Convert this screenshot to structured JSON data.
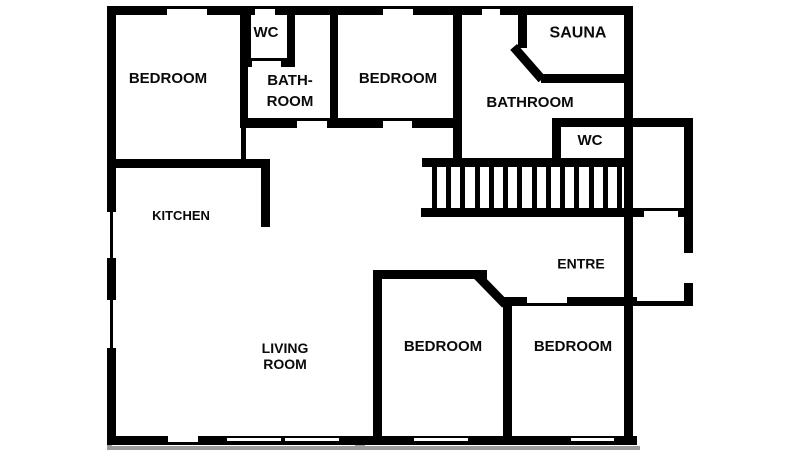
{
  "figure": {
    "width": 800,
    "height": 450,
    "background": "#ffffff"
  },
  "palette": {
    "wall": "#000000",
    "line": "#000000",
    "cut": "#ffffff",
    "shadow": "#9b9b9b"
  },
  "rooms": [
    {
      "id": "bedroom-top-left",
      "lines": [
        "BEDROOM"
      ],
      "cx": 168,
      "cy": 79,
      "fs": 15,
      "lh": 18
    },
    {
      "id": "wc-top",
      "lines": [
        "WC"
      ],
      "cx": 266,
      "cy": 33,
      "fs": 15,
      "lh": 18
    },
    {
      "id": "bathroom-small",
      "lines": [
        "BATH-",
        "ROOM"
      ],
      "cx": 290,
      "cy": 91,
      "fs": 15,
      "lh": 21
    },
    {
      "id": "bedroom-top-middle",
      "lines": [
        "BEDROOM"
      ],
      "cx": 398,
      "cy": 79,
      "fs": 15,
      "lh": 18
    },
    {
      "id": "sauna",
      "lines": [
        "SAUNA"
      ],
      "cx": 578,
      "cy": 33,
      "fs": 16,
      "lh": 19
    },
    {
      "id": "bathroom-main",
      "lines": [
        "BATHROOM"
      ],
      "cx": 530,
      "cy": 103,
      "fs": 15,
      "lh": 18
    },
    {
      "id": "wc-right",
      "lines": [
        "WC"
      ],
      "cx": 590,
      "cy": 141,
      "fs": 15,
      "lh": 18
    },
    {
      "id": "kitchen",
      "lines": [
        "KITCHEN"
      ],
      "cx": 181,
      "cy": 216,
      "fs": 13,
      "lh": 16
    },
    {
      "id": "entre",
      "lines": [
        "ENTRE"
      ],
      "cx": 581,
      "cy": 264,
      "fs": 14,
      "lh": 17
    },
    {
      "id": "living-room",
      "lines": [
        "LIVING",
        "ROOM"
      ],
      "cx": 285,
      "cy": 356,
      "fs": 14,
      "lh": 16
    },
    {
      "id": "bedroom-bottom-middle",
      "lines": [
        "BEDROOM"
      ],
      "cx": 443,
      "cy": 347,
      "fs": 15,
      "lh": 18
    },
    {
      "id": "bedroom-bottom-right",
      "lines": [
        "BEDROOM"
      ],
      "cx": 573,
      "cy": 347,
      "fs": 15,
      "lh": 18
    }
  ],
  "plan": {
    "walls": [
      {
        "name": "top-wall-seg",
        "x": 107,
        "y": 6,
        "w": 60,
        "h": 9
      },
      {
        "name": "top-wall-seg",
        "x": 207,
        "y": 6,
        "w": 48,
        "h": 9
      },
      {
        "name": "top-wall-seg",
        "x": 275,
        "y": 6,
        "w": 108,
        "h": 9
      },
      {
        "name": "top-wall-seg",
        "x": 413,
        "y": 6,
        "w": 69,
        "h": 9
      },
      {
        "name": "top-wall-seg",
        "x": 500,
        "y": 6,
        "w": 133,
        "h": 9
      },
      {
        "name": "left-wall-seg",
        "x": 107,
        "y": 6,
        "w": 9,
        "h": 206
      },
      {
        "name": "left-wall-seg",
        "x": 107,
        "y": 258,
        "w": 9,
        "h": 42
      },
      {
        "name": "left-wall-seg",
        "x": 107,
        "y": 348,
        "w": 9,
        "h": 92
      },
      {
        "name": "bottom-wall",
        "x": 107,
        "y": 436,
        "w": 530,
        "h": 9
      },
      {
        "name": "right-main-wall",
        "x": 624,
        "y": 6,
        "w": 9,
        "h": 439
      },
      {
        "name": "wc-right-top-wall",
        "x": 552,
        "y": 118,
        "w": 141,
        "h": 9
      },
      {
        "name": "right-outer-wall-seg",
        "x": 684,
        "y": 118,
        "w": 9,
        "h": 135
      },
      {
        "name": "right-outer-wall-seg",
        "x": 684,
        "y": 283,
        "w": 9,
        "h": 23
      },
      {
        "name": "wc-top-left-wall",
        "x": 243,
        "y": 15,
        "w": 8,
        "h": 52
      },
      {
        "name": "wc-top-right-wall",
        "x": 287,
        "y": 15,
        "w": 8,
        "h": 52
      },
      {
        "name": "wc-top-bottom-wall-seg",
        "x": 243,
        "y": 58,
        "w": 9,
        "h": 9
      },
      {
        "name": "wc-top-bottom-wall-seg",
        "x": 281,
        "y": 58,
        "w": 14,
        "h": 9
      },
      {
        "name": "bathroom-small-left-wall",
        "x": 240,
        "y": 15,
        "w": 8,
        "h": 113
      },
      {
        "name": "bathroom-small-left-thin",
        "x": 241,
        "y": 128,
        "w": 5,
        "h": 34
      },
      {
        "name": "hall-top-wall-seg",
        "x": 240,
        "y": 118,
        "w": 57,
        "h": 10
      },
      {
        "name": "hall-top-wall-seg",
        "x": 327,
        "y": 118,
        "w": 56,
        "h": 10
      },
      {
        "name": "hall-top-wall-seg",
        "x": 412,
        "y": 118,
        "w": 48,
        "h": 10
      },
      {
        "name": "bedroom-middle-left-wall",
        "x": 330,
        "y": 15,
        "w": 8,
        "h": 106
      },
      {
        "name": "bedroom-middle-right-wall",
        "x": 453,
        "y": 15,
        "w": 9,
        "h": 147
      },
      {
        "name": "sauna-left-wall",
        "x": 518,
        "y": 15,
        "w": 9,
        "h": 33
      },
      {
        "name": "sauna-bottom-wall",
        "x": 541,
        "y": 74,
        "w": 92,
        "h": 9
      },
      {
        "name": "wc-right-left-wall",
        "x": 552,
        "y": 127,
        "w": 9,
        "h": 35
      },
      {
        "name": "stairs-top-rail",
        "x": 422,
        "y": 158,
        "w": 211,
        "h": 9
      },
      {
        "name": "stairs-bottom-rail-seg",
        "x": 421,
        "y": 208,
        "w": 223,
        "h": 9
      },
      {
        "name": "stairs-bottom-rail-seg",
        "x": 678,
        "y": 208,
        "w": 15,
        "h": 9
      },
      {
        "name": "kitchen-top-wall",
        "x": 107,
        "y": 159,
        "w": 163,
        "h": 9
      },
      {
        "name": "kitchen-right-wall",
        "x": 261,
        "y": 159,
        "w": 9,
        "h": 68
      },
      {
        "name": "bedroom-bm-left-wall",
        "x": 373,
        "y": 270,
        "w": 9,
        "h": 170
      },
      {
        "name": "bedroom-bm-top-wall",
        "x": 373,
        "y": 270,
        "w": 114,
        "h": 9
      },
      {
        "name": "bedrooms-divider-wall",
        "x": 503,
        "y": 297,
        "w": 9,
        "h": 143
      },
      {
        "name": "entre-bottom-wall-seg",
        "x": 503,
        "y": 297,
        "w": 24,
        "h": 9
      },
      {
        "name": "entre-bottom-wall-seg",
        "x": 567,
        "y": 297,
        "w": 70,
        "h": 9
      },
      {
        "name": "entre-bottom-wall-thin",
        "x": 637,
        "y": 301,
        "w": 47,
        "h": 5
      }
    ],
    "lines": [
      {
        "name": "window-marker",
        "x": 167,
        "y": 6,
        "w": 40,
        "h": 3
      },
      {
        "name": "window-marker",
        "x": 255,
        "y": 6,
        "w": 20,
        "h": 3
      },
      {
        "name": "window-marker",
        "x": 383,
        "y": 6,
        "w": 30,
        "h": 3
      },
      {
        "name": "window-marker",
        "x": 482,
        "y": 6,
        "w": 18,
        "h": 3
      },
      {
        "name": "window-marker",
        "x": 110,
        "y": 212,
        "w": 3,
        "h": 46
      },
      {
        "name": "window-marker",
        "x": 110,
        "y": 300,
        "w": 3,
        "h": 48
      },
      {
        "name": "door-header",
        "x": 252,
        "y": 58,
        "w": 29,
        "h": 3
      },
      {
        "name": "door-header",
        "x": 297,
        "y": 118,
        "w": 30,
        "h": 3
      },
      {
        "name": "door-header",
        "x": 383,
        "y": 118,
        "w": 29,
        "h": 3
      },
      {
        "name": "door-header",
        "x": 644,
        "y": 208,
        "w": 34,
        "h": 3
      },
      {
        "name": "door-header",
        "x": 527,
        "y": 303,
        "w": 40,
        "h": 3
      }
    ],
    "cuts": [
      {
        "name": "door-opening",
        "x": 168,
        "y": 436,
        "w": 30,
        "h": 6
      },
      {
        "name": "window-slit",
        "x": 227,
        "y": 438,
        "w": 54,
        "h": 3
      },
      {
        "name": "window-slit",
        "x": 285,
        "y": 438,
        "w": 54,
        "h": 3
      },
      {
        "name": "window-slit",
        "x": 414,
        "y": 438,
        "w": 54,
        "h": 3
      },
      {
        "name": "window-slit",
        "x": 571,
        "y": 438,
        "w": 43,
        "h": 3
      }
    ],
    "shadows": [
      {
        "name": "shadow-line",
        "x": 107,
        "y": 446,
        "w": 533,
        "h": 4
      },
      {
        "name": "shadow-stub",
        "x": 355,
        "y": 445,
        "w": 10,
        "h": 5
      },
      {
        "name": "shadow-stub",
        "x": 107,
        "y": 445,
        "w": 5,
        "h": 5
      }
    ],
    "diagonals": [
      {
        "name": "sauna-chamfer-wall",
        "x": 517,
        "y": 44,
        "len": 43,
        "angle": 48.8,
        "th": 9
      },
      {
        "name": "bedroom-chamfer-wall",
        "x": 480,
        "y": 272,
        "len": 41,
        "angle": 45.8,
        "th": 9
      }
    ],
    "stairs": {
      "x1": 432,
      "x2": 617,
      "y": 167,
      "h": 41,
      "count": 14,
      "tread_w": 5
    }
  }
}
